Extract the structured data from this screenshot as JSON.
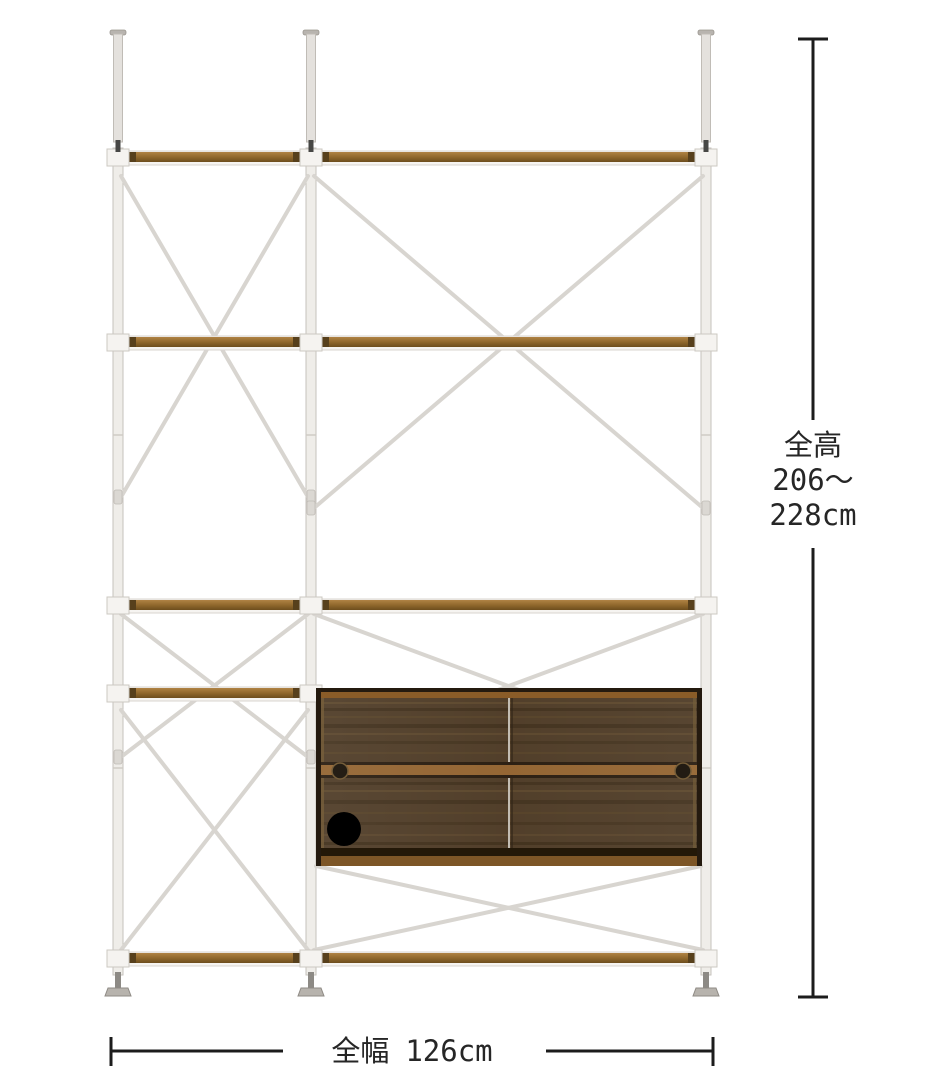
{
  "diagram": {
    "subject": "tension-pole shelving unit with sliding-door cabinet",
    "dimensions": {
      "height": {
        "lines": [
          "全高",
          "206〜",
          "228cm"
        ]
      },
      "width": {
        "label": "全幅",
        "value": "126cm"
      }
    }
  },
  "colors": {
    "background": "#ffffff",
    "dimension_line": "#1c1c1c",
    "dimension_text": "#262626",
    "frame_white": "#efede9",
    "brace": "#d8d5d0",
    "shelf_wood": "#96702f",
    "cabinet_body": "#4f3c27",
    "cabinet_rail": "#936431",
    "cabinet_frame": "#241a0f"
  }
}
